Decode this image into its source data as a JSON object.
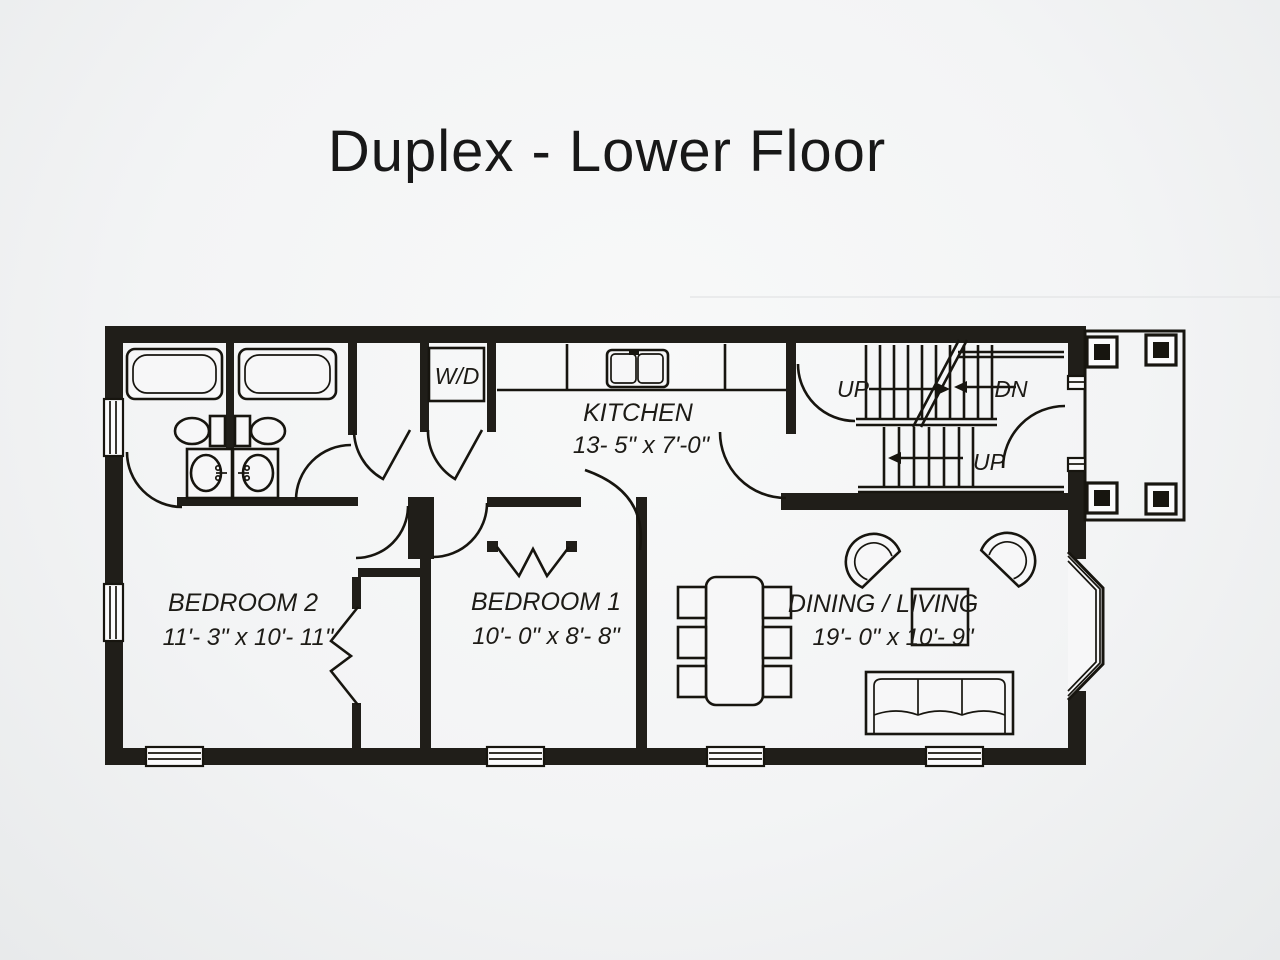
{
  "title": "Duplex - Lower Floor",
  "floor_plan": {
    "rooms": [
      {
        "name": "BEDROOM 2",
        "dimensions": "11'- 3\" x 10'- 11\""
      },
      {
        "name": "BEDROOM 1",
        "dimensions": "10'- 0\" x 8'- 8\""
      },
      {
        "name": "KITCHEN",
        "dimensions": "13- 5\" x 7'-0\""
      },
      {
        "name": "DINING / LIVING",
        "dimensions": "19'- 0\" x 10'- 9\""
      }
    ],
    "labels": {
      "laundry": "W/D",
      "stair_up_upper": "UP",
      "stair_down": "DN",
      "stair_up_lower": "UP"
    },
    "fixture_icons": [
      "bathtub-icon",
      "toilet-icon",
      "sink-icon",
      "kitchen-sink-icon",
      "stairs-icon",
      "dining-table-icon",
      "chair-icon",
      "armchair-icon",
      "sofa-icon",
      "end-table-icon",
      "bay-window-icon",
      "porch-post-icon",
      "door-swing-icon",
      "bifold-door-icon",
      "window-icon"
    ]
  },
  "colors": {
    "background": "#f2f3f4",
    "wall": "#201e19",
    "line": "#17150f",
    "title_text": "#181818"
  }
}
